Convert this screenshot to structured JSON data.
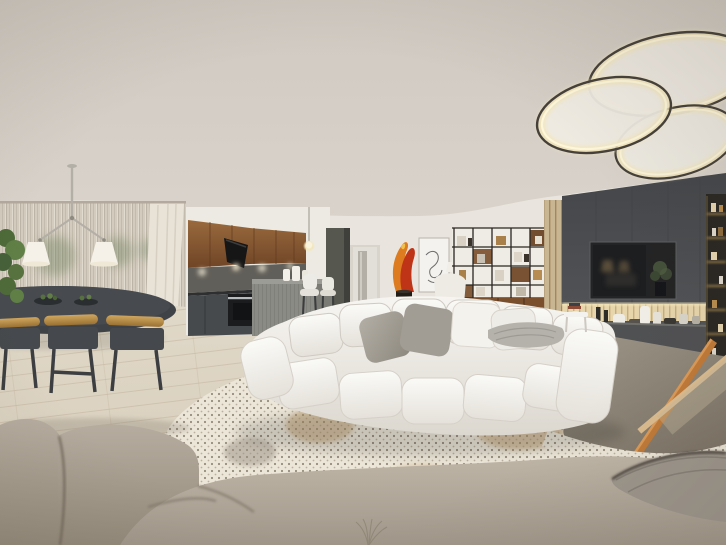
{
  "meta": {
    "content_type": "interior-360-panorama-render",
    "room": "open-plan living room with dining area, kitchen, media wall and lounge cushions"
  },
  "palette": {
    "ceiling": "#d2ccc4",
    "wall": "#e9e5de",
    "curtain": "#d2cabd",
    "curtainBright": "#e9e3d7",
    "floor": "#ddd4c3",
    "plankLine": "#c2b49c",
    "greenery": "#56713f",
    "diningTable": "#3f4347",
    "chairOak": "#c2944f",
    "chairDark": "#45484c",
    "kitchenWood": "#8a5a33",
    "backsplash": "#615f59",
    "baseCabinet": "#474a4c",
    "island": "#8b8b85",
    "tallCabinet": "#56574f",
    "doorWhite": "#e2dfd8",
    "flameOrange": "#dd7b20",
    "flameRed": "#bf3316",
    "shelfWood": "#7a4f2e",
    "shelfFrame": "#2a2521",
    "slatWood": "#c8b591",
    "tvWall": "#4c4e52",
    "tvScreen": "#1d1e20",
    "slatLit": "#e7d5ac",
    "ledge": "#505153",
    "displayShelf": "#2a2723",
    "shelfGlow": "#caa35c",
    "sofa": "#f2f0ec",
    "sofaSeam": "#cfcac2",
    "pillowGray": "#a29d94",
    "throwGray": "#b5b2ac",
    "rugBase": "#ece6d8",
    "rugDot": "#7e7465",
    "rugTan": "#c0a071",
    "tableTop": "#8b8375",
    "tableRail": "#c07a38",
    "tableRailLight": "#dcbd90",
    "cushion": "#b0a699",
    "cushionDark": "#8f8578",
    "knitThrow": "#9d968c",
    "lampGlow": "#f3e6bb",
    "ringRim": "#45403a",
    "shadeWhite": "#f5f1e8"
  },
  "scene": {
    "elements": [
      "ceiling",
      "ceiling-ring-light",
      "pendant-lamp",
      "sheer-curtains",
      "indoor-plant",
      "dining-table",
      "dining-chairs",
      "kitchen-upper-cabinets",
      "range-hood",
      "kitchen-base-cabinets",
      "oven",
      "kitchen-island",
      "bar-stools",
      "tall-cabinet",
      "hallway-door",
      "flame-sculpture",
      "framed-art",
      "wall-lamp",
      "shelving-unit",
      "armchair",
      "slat-panel",
      "tv-wall",
      "television",
      "plant-niche",
      "backlit-slats",
      "decor-ledge",
      "display-shelf",
      "modular-sofa",
      "pillows",
      "throw-blanket",
      "side-table",
      "patterned-rug",
      "wood-floor",
      "coffee-table",
      "floor-cushions",
      "knit-throw"
    ]
  }
}
